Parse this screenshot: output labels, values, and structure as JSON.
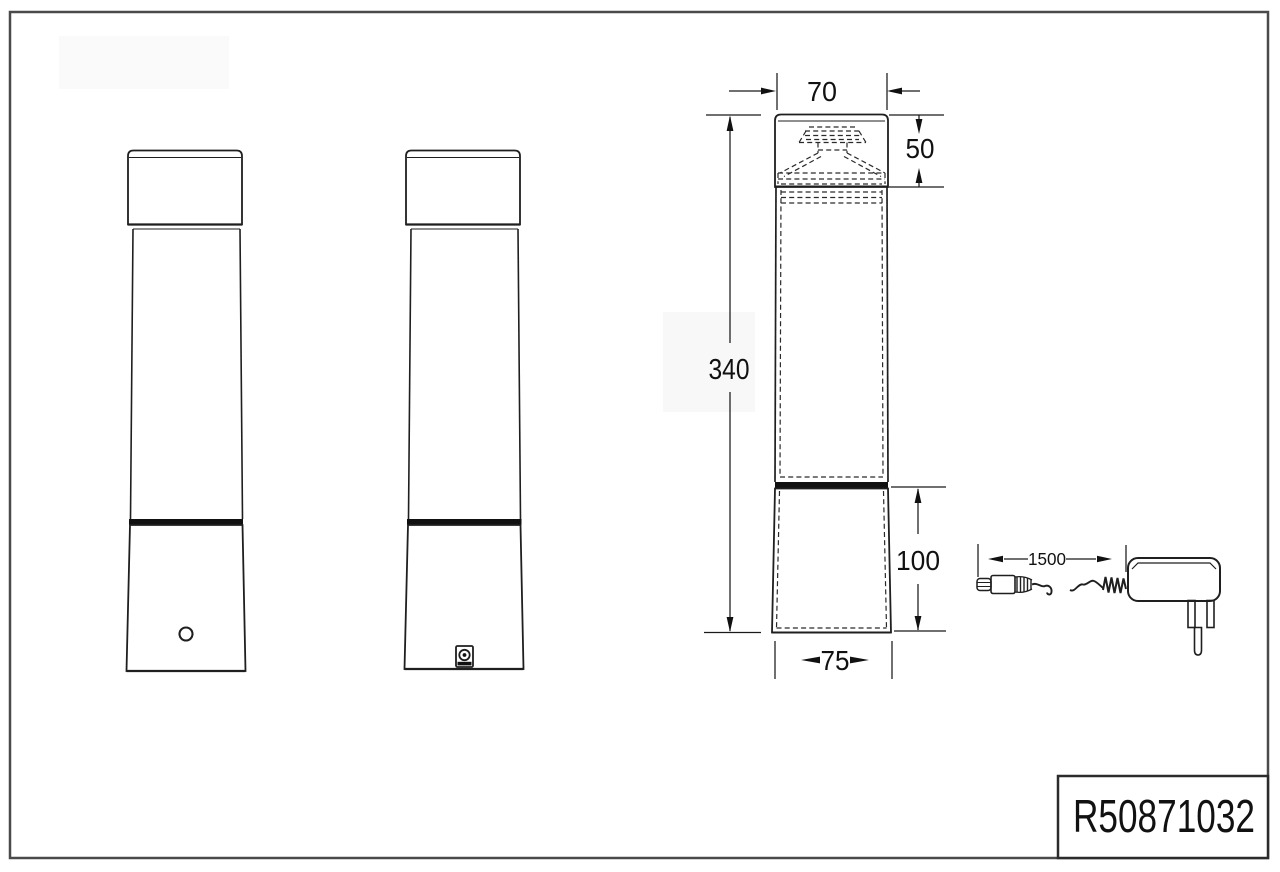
{
  "title_block": {
    "product_code": "R50871032"
  },
  "dimensions": {
    "head_width": "70",
    "head_height": "50",
    "total_height": "340",
    "base_height": "100",
    "base_width": "75",
    "cable_length": "1500"
  }
}
